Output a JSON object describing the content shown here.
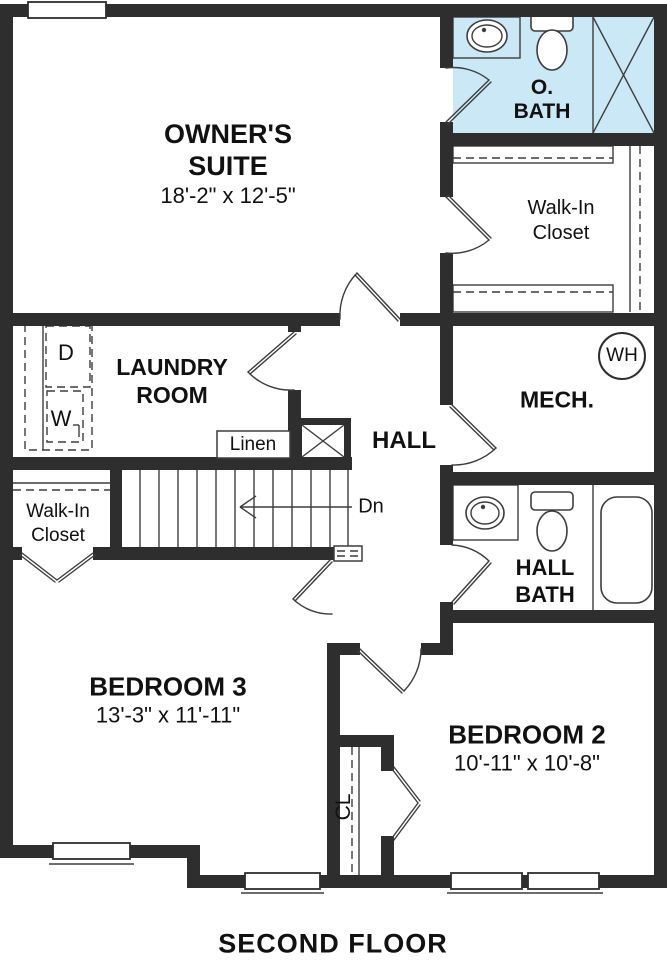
{
  "plan": {
    "title": "SECOND FLOOR",
    "rooms": {
      "owners_suite": {
        "line1": "OWNER'S",
        "line2": "SUITE",
        "dims": "18'-2\" x 12'-5\""
      },
      "o_bath": {
        "line1": "O.",
        "line2": "BATH"
      },
      "walk_in_closet_top": {
        "line1": "Walk-In",
        "line2": "Closet"
      },
      "laundry": {
        "line1": "LAUNDRY",
        "line2": "ROOM"
      },
      "mech": {
        "label": "MECH."
      },
      "hall": {
        "label": "HALL"
      },
      "linen": {
        "label": "Linen"
      },
      "hall_bath": {
        "line1": "HALL",
        "line2": "BATH"
      },
      "bedroom3": {
        "label": "BEDROOM 3",
        "dims": "13'-3\" x 11'-11\""
      },
      "bedroom2": {
        "label": "BEDROOM 2",
        "dims": "10'-11\" x 10'-8\""
      },
      "closet_cl": {
        "label": "CL"
      },
      "walk_in_closet_left": {
        "line1": "Walk-In",
        "line2": "Closet"
      }
    },
    "annotations": {
      "stairs_direction": "Dn",
      "water_heater": "WH",
      "dryer": "D",
      "washer": "W"
    },
    "fixtures": [
      "sink",
      "toilet",
      "shower",
      "bathtub",
      "water-heater",
      "washer",
      "dryer",
      "stairs"
    ],
    "colors": {
      "wall": "#2e2e2e",
      "line": "#3d3d3d",
      "bath_highlight": "#cbe8f6",
      "background": "#ffffff",
      "text": "#111111"
    }
  }
}
